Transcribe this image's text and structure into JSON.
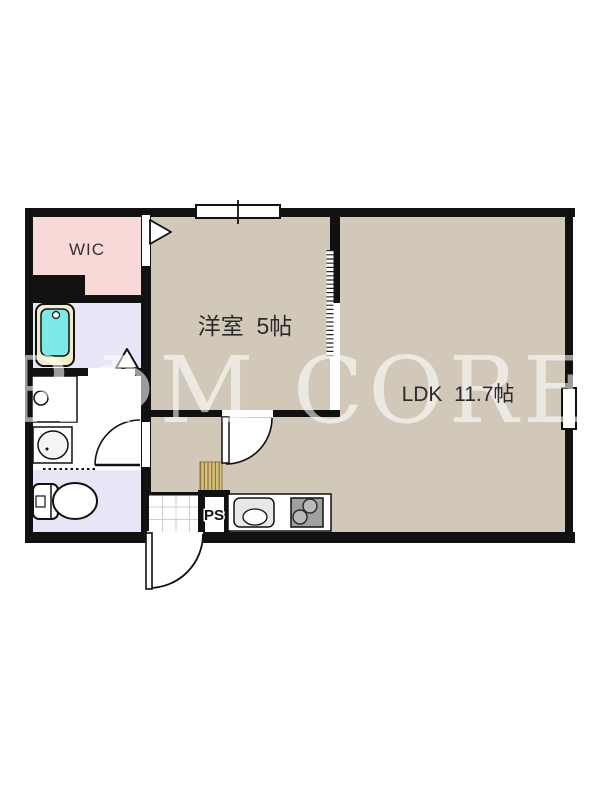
{
  "plan": {
    "title": "1LDK apartment floor plan",
    "watermark_text": "RΦM CORE",
    "rooms": {
      "wic": {
        "label": "WIC"
      },
      "western_room": {
        "label": "洋室  5帖"
      },
      "ldk": {
        "label": "LDK  11.7帖"
      },
      "pipe_space": {
        "label": "PS"
      }
    },
    "fixtures": [
      "bathtub",
      "bathroom-door-triangle",
      "washing-machine-pan",
      "washbasin",
      "toilet",
      "kitchen-sink",
      "gas-stove",
      "shoe-step",
      "genkan-tile",
      "entrance-door",
      "western-room-door",
      "washroom-door",
      "sliding-partition",
      "wic-door-triangle",
      "window",
      "side-window"
    ],
    "colors": {
      "wall": "#111111",
      "floor_beige": "#d2c8b9",
      "wic_pink": "#f9d8d8",
      "bath_lavender": "#e6e6f7",
      "bathtub_cyan": "#7fe9e9",
      "bathtub_rim": "#f2edc8",
      "wood_step": "#d9c379",
      "stove_gray": "#9fa0a2",
      "sink_gray": "#e8e8e8",
      "watermark": "rgba(255,255,255,0.58)"
    }
  }
}
